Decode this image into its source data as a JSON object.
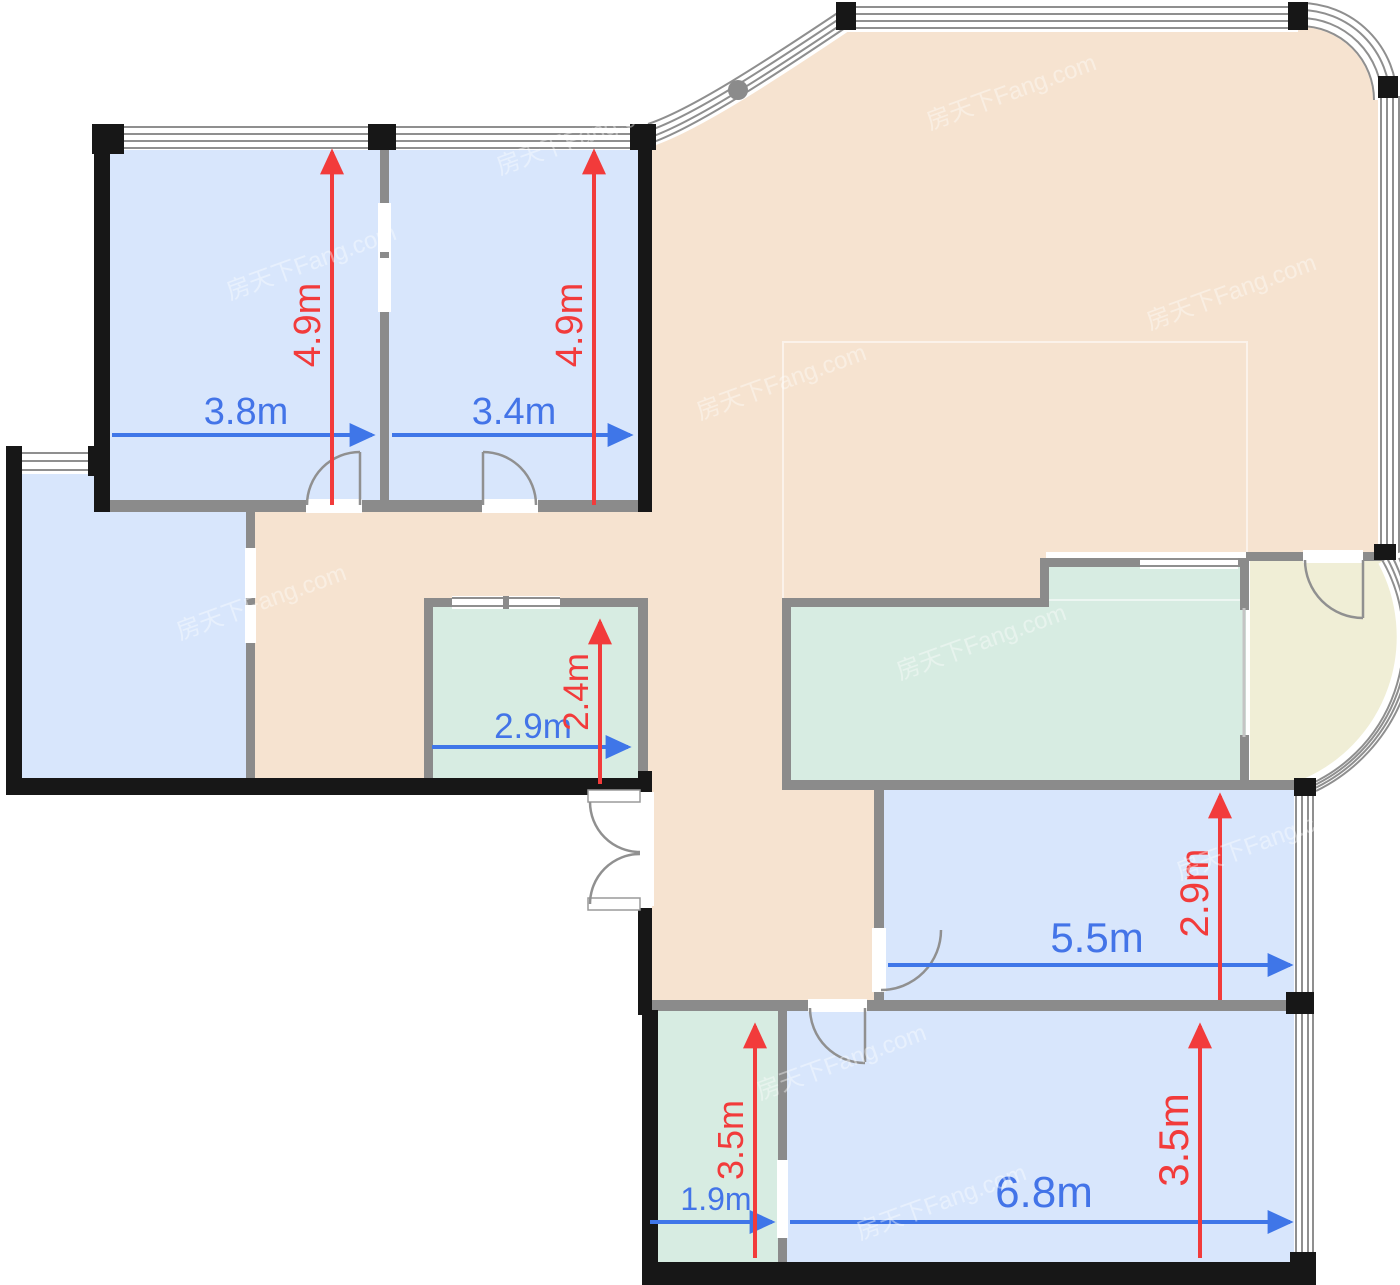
{
  "plan": {
    "title_hidden": "",
    "watermark": "房天下Fang.com",
    "colors": {
      "room_blue": "#d8e6fc",
      "hall_beige": "#f6e3d0",
      "utility_teal": "#d7ece2",
      "balcony_cream": "#f0eed6",
      "wall_gray": "#8b8b8b",
      "wall_black": "#171717",
      "dimension_red": "#f23b3b",
      "dimension_blue": "#4374e8"
    },
    "dimensions": {
      "bedroom_left": {
        "width": {
          "label": "3.8m",
          "meters": 3.8
        },
        "depth": {
          "label": "4.9m",
          "meters": 4.9
        }
      },
      "bedroom_right": {
        "width": {
          "label": "3.4m",
          "meters": 3.4
        },
        "depth": {
          "label": "4.9m",
          "meters": 4.9
        }
      },
      "bathroom": {
        "width": {
          "label": "2.9m",
          "meters": 2.9
        },
        "depth": {
          "label": "2.4m",
          "meters": 2.4
        }
      },
      "room_mid_right": {
        "width": {
          "label": "5.5m",
          "meters": 5.5
        },
        "depth": {
          "label": "2.9m",
          "meters": 2.9
        }
      },
      "room_bottom_small": {
        "width": {
          "label": "1.9m",
          "meters": 1.9
        },
        "depth": {
          "label": "3.5m",
          "meters": 3.5
        }
      },
      "room_bottom_large": {
        "width": {
          "label": "6.8m",
          "meters": 6.8
        },
        "depth": {
          "label": "3.5m",
          "meters": 3.5
        }
      }
    }
  }
}
